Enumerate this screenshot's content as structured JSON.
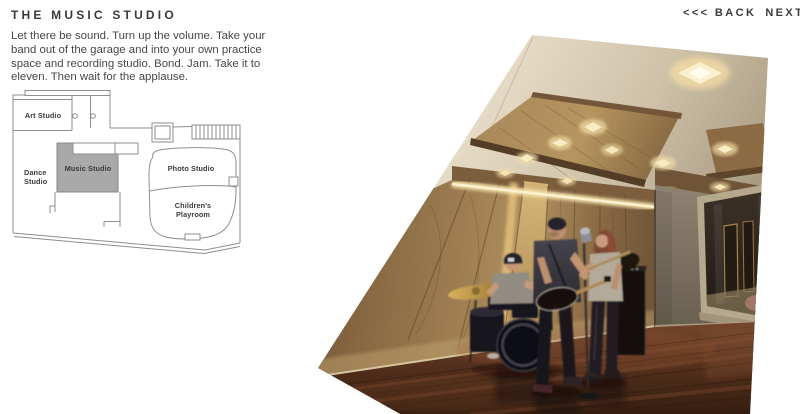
{
  "header": {
    "title": "THE MUSIC STUDIO"
  },
  "nav": {
    "back_label": "<<< BACK",
    "next_label": "NEXT >>>"
  },
  "intro": {
    "text": "Let there be sound. Turn up the volume. Take your band out of the garage and into your own practice space and recording studio. Bond. Jam. Take it to eleven. Then wait for the applause."
  },
  "floorplan": {
    "highlighted_room": "Music Studio",
    "highlight_color": "#a9a9a9",
    "line_color": "#8e8e8e",
    "label_color": "#3b3b3b",
    "rooms": {
      "art_studio": "Art Studio",
      "dance_line1": "Dance",
      "dance_line2": "Studio",
      "music_studio": "Music Studio",
      "photo_studio": "Photo Studio",
      "children_line1": "Children's",
      "children_line2": "Playroom"
    }
  },
  "photo": {
    "description": "Rotated rendering of the music studio: band with drummer, guitarist and bassist in a wood-paneled room",
    "colors": {
      "ceiling": "#cdbfa6",
      "wood_panel": "#9a7a4e",
      "right_wall": "#7b7060",
      "floor": "#5a331f",
      "cove_glow": "#f5dfa8",
      "window_accent_pink": "#d96b7c"
    }
  }
}
